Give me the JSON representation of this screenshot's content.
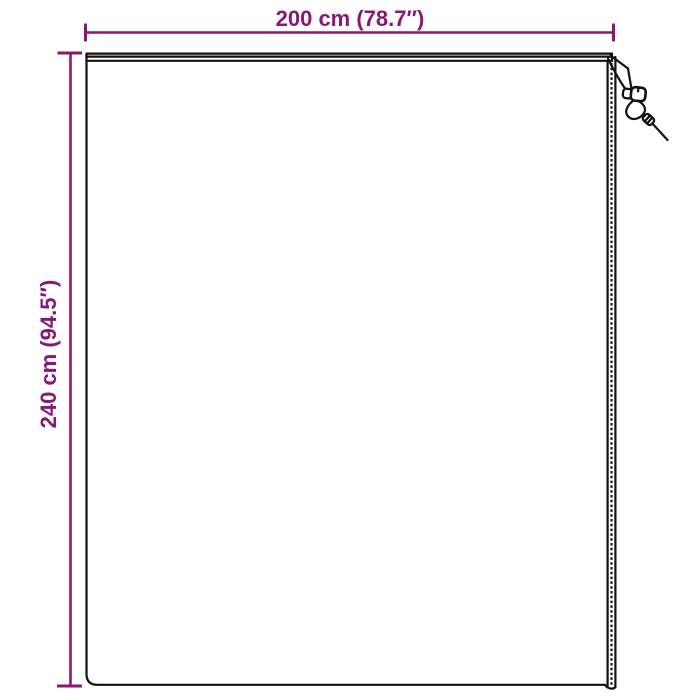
{
  "diagram": {
    "kind": "product-dimension-diagram",
    "subject": "rectangular cover with drawstring toggle and zipped edge"
  },
  "dimensions": {
    "width": {
      "label": "200 cm (78.7″)",
      "cm": 200,
      "inches": 78.7
    },
    "height": {
      "label": "240 cm (94.5″)",
      "cm": 240,
      "inches": 94.5
    }
  },
  "colors": {
    "accent": "#891777",
    "outline": "#121212",
    "background": "#ffffff"
  }
}
